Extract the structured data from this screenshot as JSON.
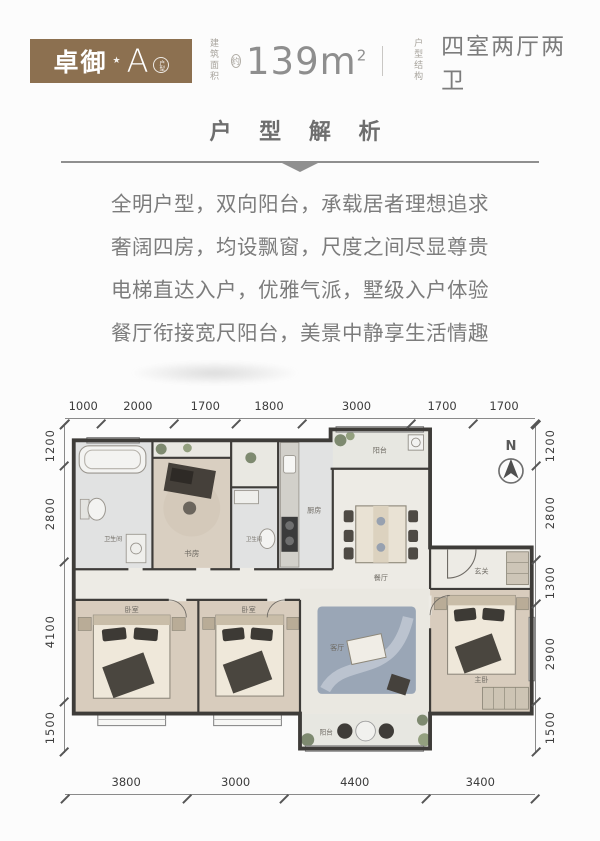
{
  "header": {
    "badge": {
      "char1": "卓",
      "char2": "御",
      "star": "★",
      "unit": "A",
      "unit_tag": "户型"
    },
    "area": {
      "label_top": "建筑",
      "label_bottom": "面积",
      "approx": "约",
      "value": "139",
      "unit": "m",
      "sup": "2"
    },
    "structure": {
      "label_top": "户型",
      "label_bottom": "结构",
      "value": "四室两厅两卫"
    }
  },
  "section_title": "户 型 解 析",
  "description_lines": [
    "全明户型，双向阳台，承载居者理想追求",
    "奢阔四房，均设飘窗，尺度之间尽显尊贵",
    "电梯直达入户，优雅气派，墅级入户体验",
    "餐厅衔接宽尺阳台，美景中静享生活情趣"
  ],
  "floorplan": {
    "compass_label": "N",
    "rooms": {
      "bath": "卫生间",
      "study": "书房",
      "kitchen": "厨房",
      "balcony": "阳台",
      "dining": "餐厅",
      "foyer": "玄关",
      "living": "客厅",
      "bedroom": "卧室",
      "master": "主卧"
    },
    "dims": {
      "top": [
        "1000",
        "2000",
        "1700",
        "1800",
        "3000",
        "1700",
        "1700"
      ],
      "bottom": [
        "3800",
        "3000",
        "4400",
        "3400"
      ],
      "left": [
        "1200",
        "2800",
        "4100",
        "1500"
      ],
      "right": [
        "1200",
        "2800",
        "1300",
        "2900",
        "1500"
      ]
    }
  },
  "colors": {
    "badge_brown": "#8c7050",
    "text_gray": "#7c7c7c",
    "value_gray": "#8e8e8e",
    "wall_dark": "#3e3c39",
    "wood_floor": "#d8ccbd",
    "tile_floor": "#e1e2e2"
  }
}
